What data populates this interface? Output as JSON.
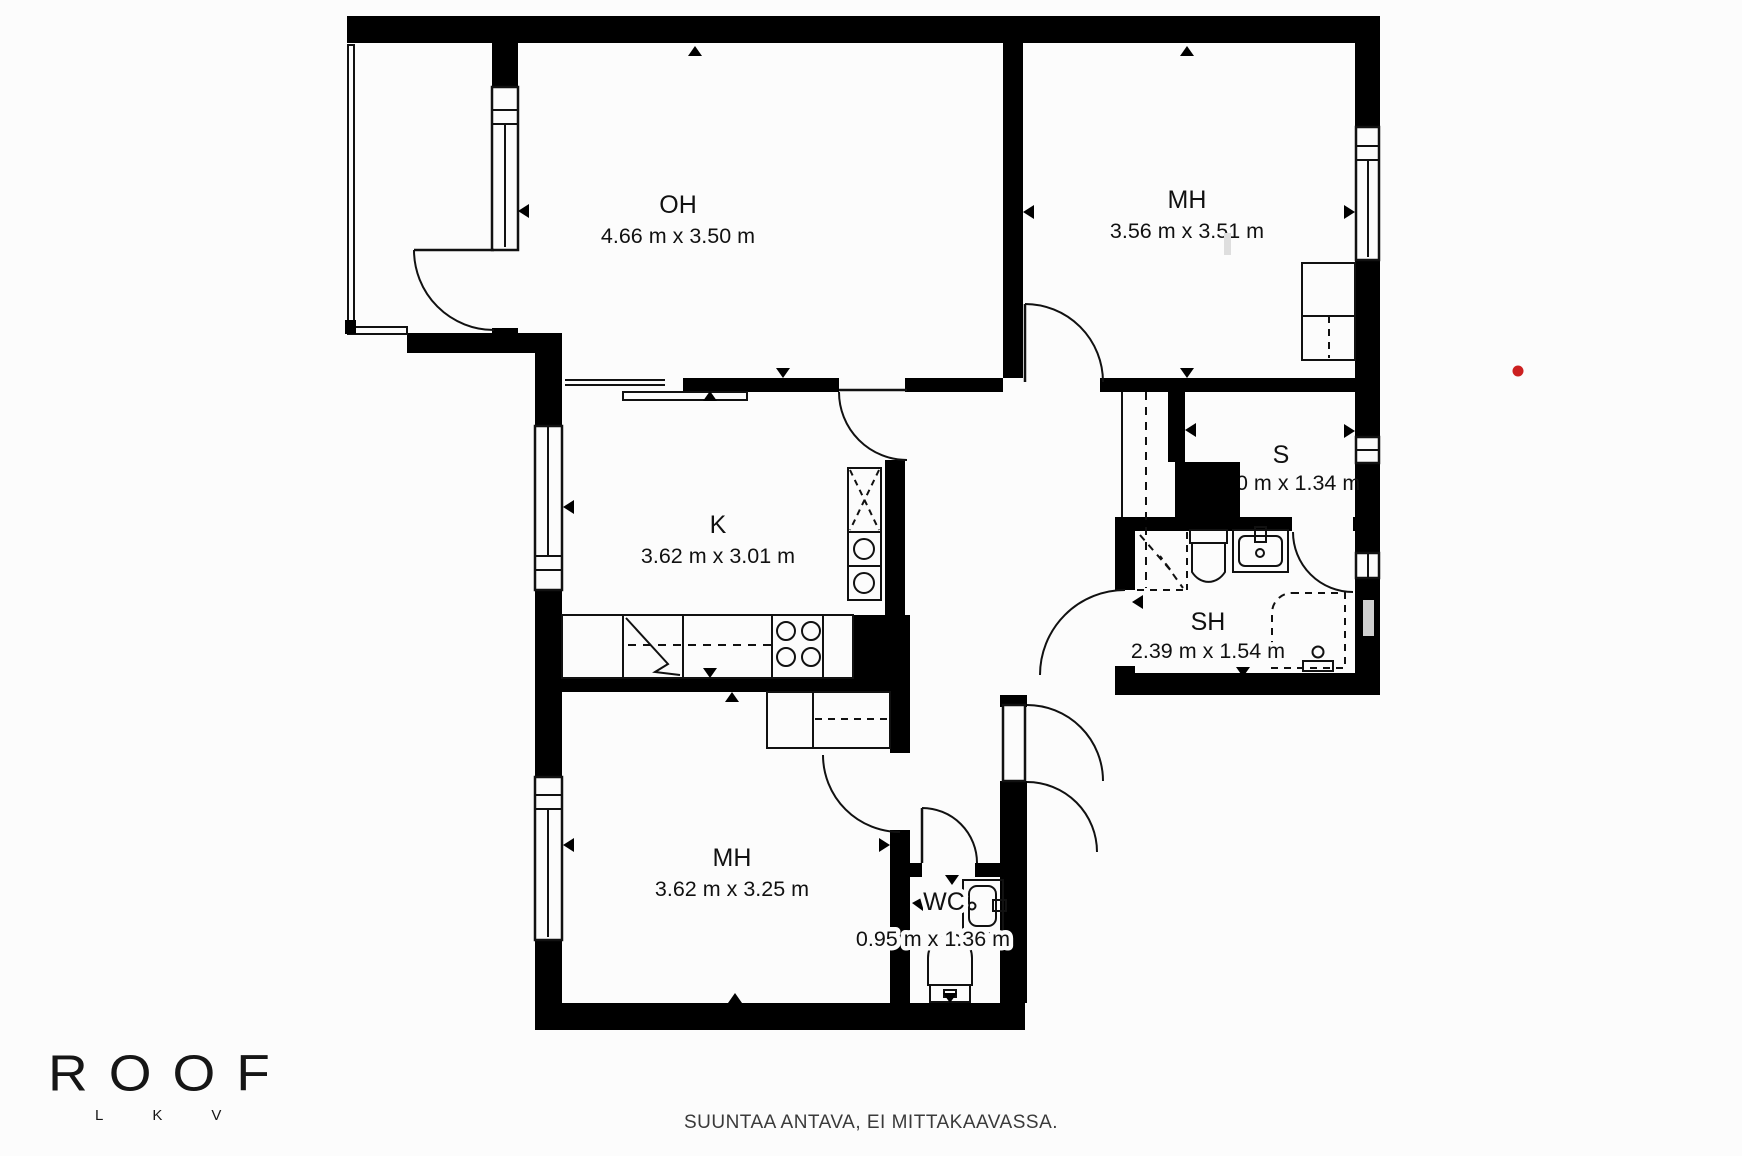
{
  "rooms": [
    {
      "id": "oh",
      "label": "OH",
      "dims": "4.66 m x 3.50 m"
    },
    {
      "id": "mh-top",
      "label": "MH",
      "dims": "3.56 m x 3.51 m"
    },
    {
      "id": "k",
      "label": "K",
      "dims": "3.62 m x 3.01 m"
    },
    {
      "id": "s",
      "label": "S",
      "dims": "0 m x 1.34 m"
    },
    {
      "id": "sh",
      "label": "SH",
      "dims": "2.39 m x 1.54 m"
    },
    {
      "id": "mh-bottom",
      "label": "MH",
      "dims": "3.62 m x 3.25 m"
    },
    {
      "id": "wc",
      "label": "WC",
      "dims": "0.95 m x 1.36 m"
    }
  ],
  "logo": {
    "name": "ROOF",
    "sub": "LKV"
  },
  "footer": {
    "disclaimer": "SUUNTAA ANTAVA, EI MITTAKAAVASSA."
  },
  "marker": {
    "color": "#cc2020"
  },
  "colors": {
    "wall": "#000000",
    "background": "#fcfcfc",
    "line": "#111111",
    "watermark": "#cfcfcf"
  }
}
